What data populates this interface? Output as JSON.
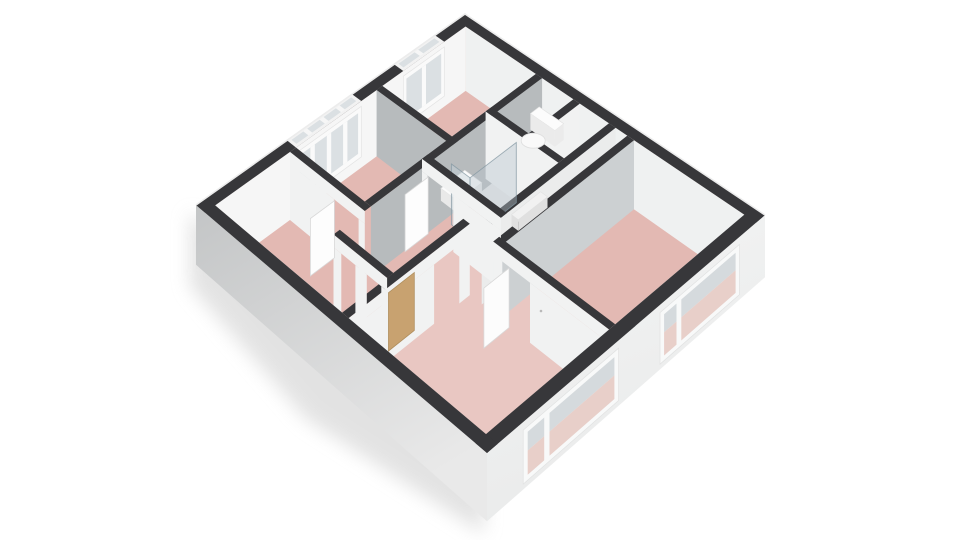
{
  "view": {
    "width": 960,
    "height": 540,
    "description": "3D axonometric floor plan render, first floor, no text labels",
    "background": "#ffffff"
  },
  "colors": {
    "band": "#37373a",
    "rim": "#ececec",
    "floorPink": "#e3b9b3",
    "floorPinkLight": "#eed3cd",
    "floorGray": "#e9eaea",
    "floorDuct": "#e2e3e3",
    "faceNorth": "#eff1f1",
    "faceWest": "#f6f6f6",
    "faceWhite": "#f1f2f2",
    "faceLight": "#ebecec",
    "faceGray": "#b7bbbd",
    "faceGrayLight": "#ccd0d2",
    "frame": "#fafafa",
    "glass": "#dbe0e3",
    "glassTop": "#d5dadd",
    "glassPink": "#e8cfc9",
    "facadeLeftTop": "#c3c5c6",
    "facadeLeftBottom": "#e9e9e9",
    "facadeRightTop": "#f4f5f5",
    "facadeRightBottom": "#e9eaea",
    "doorTan": "#c8a270",
    "shadow": "#dcdcdc"
  },
  "projection": {
    "corners": {
      "T": [
        465,
        14
      ],
      "R": [
        765,
        215
      ],
      "B": [
        487,
        453
      ],
      "L": [
        196,
        205
      ]
    },
    "ext_band": 0.035,
    "wall_band": 0.022,
    "face_h": 64,
    "facade_h": 55
  },
  "shadow_points": [
    [
      190,
      212
    ],
    [
      484,
      460
    ],
    [
      484,
      534
    ],
    [
      306,
      419
    ],
    [
      190,
      286
    ]
  ],
  "floors": [
    {
      "name": "floor-main-pink",
      "rect": [
        0.035,
        0.035,
        0.965,
        0.965
      ],
      "fill": "floorPink"
    },
    {
      "name": "floor-bathroom",
      "rect": [
        0.29,
        0.035,
        0.562,
        0.472
      ],
      "fill": "floorGray"
    },
    {
      "name": "floor-duct-strip",
      "rect": [
        0.562,
        0.035,
        0.6,
        0.542
      ],
      "fill": "floorDuct"
    },
    {
      "name": "floor-living-room",
      "rect": [
        0.5,
        0.542,
        0.965,
        0.965
      ],
      "fill": "floorPinkLight",
      "opacity": 0.55
    }
  ],
  "back_faces": [
    {
      "name": "wall-face-north-facade",
      "axis": "u",
      "pos": 0.035,
      "span": [
        0.035,
        0.965
      ],
      "fill": "faceNorth"
    },
    {
      "name": "wall-face-west-facade",
      "axis": "v",
      "pos": 0.035,
      "span": [
        0.035,
        0.965
      ],
      "fill": "faceWest"
    }
  ],
  "back_windows": [
    {
      "name": "window-small-room",
      "from": 0.12,
      "to": 0.28,
      "mullions": [
        0.2
      ]
    },
    {
      "name": "window-bedroom-left",
      "from": 0.44,
      "to": 0.68,
      "mullions": [
        0.5,
        0.56,
        0.62
      ]
    }
  ],
  "walls_back": [
    {
      "name": "wall-smallroom-bedroom",
      "axis": "u",
      "pos": 0.36,
      "span": [
        0.035,
        0.312
      ],
      "face": "faceGray"
    },
    {
      "name": "wall-hall-west",
      "axis": "v",
      "pos": 0.29,
      "span": [
        0.035,
        0.68
      ],
      "face": "faceGray"
    },
    {
      "name": "wall-wc-east",
      "axis": "v",
      "pos": 0.42,
      "span": [
        0.035,
        0.21
      ],
      "face": "faceWhite"
    },
    {
      "name": "wall-wc-bath",
      "axis": "u",
      "pos": 0.21,
      "span": [
        0.29,
        0.54
      ],
      "face": "faceWhite"
    },
    {
      "name": "wall-bath-east",
      "axis": "v",
      "pos": 0.54,
      "span": [
        0.035,
        0.542
      ],
      "face": "faceLight"
    },
    {
      "name": "wall-bedroom-right-west",
      "axis": "v",
      "pos": 0.6,
      "span": [
        0.035,
        0.542
      ],
      "face": "faceGrayLight"
    }
  ],
  "fixtures": [
    {
      "type": "box",
      "name": "toilet-tank",
      "rect": [
        0.315,
        0.05,
        0.4,
        0.085
      ],
      "z": 0.38,
      "zb": 0.62,
      "top": "#fcfcfc",
      "front": "#ebebeb"
    },
    {
      "type": "ellipse",
      "name": "toilet-bowl",
      "at": [
        0.356,
        0.12
      ],
      "z": 0.56,
      "rx": 12,
      "ry": 7.5,
      "fill": "#f9f9f9",
      "stroke": "#dedede"
    },
    {
      "type": "box",
      "name": "bathroom-sink",
      "rect": [
        0.312,
        0.335,
        0.372,
        0.425
      ],
      "z": 0.5,
      "zb": 0.68,
      "top": "#fbfbfb",
      "front": "#e9e9e9"
    },
    {
      "type": "box",
      "name": "bathroom-radiator",
      "rect": [
        0.505,
        0.26,
        0.528,
        0.37
      ],
      "z": 0.44,
      "zb": 0.6,
      "top": "#f1f1f1",
      "front": "#e0e0e0"
    },
    {
      "type": "panel",
      "name": "shower-glass-side",
      "axis": "v",
      "pos": 0.4,
      "span": [
        0.235,
        0.41
      ],
      "z": [
        0.12,
        1.0
      ],
      "fill": "rgba(182,196,204,0.40)",
      "stroke": "rgba(130,150,160,0.75)"
    },
    {
      "type": "panel",
      "name": "shower-glass-front",
      "axis": "u",
      "pos": 0.41,
      "span": [
        0.335,
        0.4
      ],
      "z": [
        0.12,
        1.0
      ],
      "fill": "rgba(196,208,214,0.45)",
      "stroke": "rgba(130,150,160,0.75)"
    }
  ],
  "walls_front": [
    {
      "name": "wall-bedroom-left-south",
      "axis": "u",
      "pos": 0.68,
      "span": [
        0.035,
        0.312
      ],
      "face": "faceWhite",
      "gaps": [
        [
          0.2,
          0.29
        ]
      ]
    },
    {
      "name": "wall-bath-south",
      "axis": "u",
      "pos": 0.45,
      "span": [
        0.29,
        0.562
      ],
      "face": "faceWhite",
      "gaps": [
        [
          0.31,
          0.4
        ]
      ]
    },
    {
      "name": "wall-entry-east",
      "axis": "v",
      "pos": 0.5,
      "span": [
        0.542,
        0.965
      ],
      "face": "faceWhite",
      "gaps": [
        [
          0.58,
          0.67
        ]
      ]
    },
    {
      "name": "wall-entry-closet",
      "axis": "u",
      "pos": 0.79,
      "span": [
        0.312,
        0.5
      ],
      "face": "faceWhite",
      "gaps": [
        [
          0.34,
          0.39
        ],
        [
          0.43,
          0.48
        ]
      ]
    },
    {
      "name": "wall-living-north",
      "axis": "u",
      "pos": 0.52,
      "span": [
        0.6,
        0.965
      ],
      "face": "faceWhite",
      "gaps": [
        [
          0.63,
          0.72
        ]
      ]
    }
  ],
  "doors": [
    {
      "name": "door-bedroom-left",
      "axis": "v",
      "pos": 0.205,
      "span": [
        0.705,
        0.79
      ],
      "z": [
        0.18,
        1.0
      ],
      "fill": "#fdfdfd",
      "stroke": "#d9d9d9"
    },
    {
      "name": "door-bathroom",
      "axis": "v",
      "pos": 0.315,
      "span": [
        0.475,
        0.56
      ],
      "z": [
        0.18,
        1.0
      ],
      "fill": "#fdfdfd",
      "stroke": "#d9d9d9"
    },
    {
      "name": "door-living-room",
      "axis": "v",
      "pos": 0.655,
      "span": [
        0.545,
        0.635
      ],
      "z": [
        0.18,
        1.0
      ],
      "fill": "#fcfcfc",
      "stroke": "#d9d9d9"
    },
    {
      "name": "door-entry",
      "axis": "v",
      "pos": 0.503,
      "span": [
        0.72,
        0.81
      ],
      "z": [
        0.2,
        1.0
      ],
      "fill": "#c8a270",
      "stroke": "#b08f5e"
    }
  ],
  "front_windows": [
    {
      "name": "window-living-room",
      "from": 0.55,
      "to": 0.88,
      "mullion": 0.8
    },
    {
      "name": "window-bedroom-right",
      "from": 0.1,
      "to": 0.4,
      "mullion": 0.33
    }
  ],
  "rooms_legend": [
    {
      "name": "bedroom-left"
    },
    {
      "name": "small-room"
    },
    {
      "name": "wc"
    },
    {
      "name": "bathroom"
    },
    {
      "name": "hall"
    },
    {
      "name": "entry"
    },
    {
      "name": "bedroom-right"
    },
    {
      "name": "living-room"
    }
  ]
}
